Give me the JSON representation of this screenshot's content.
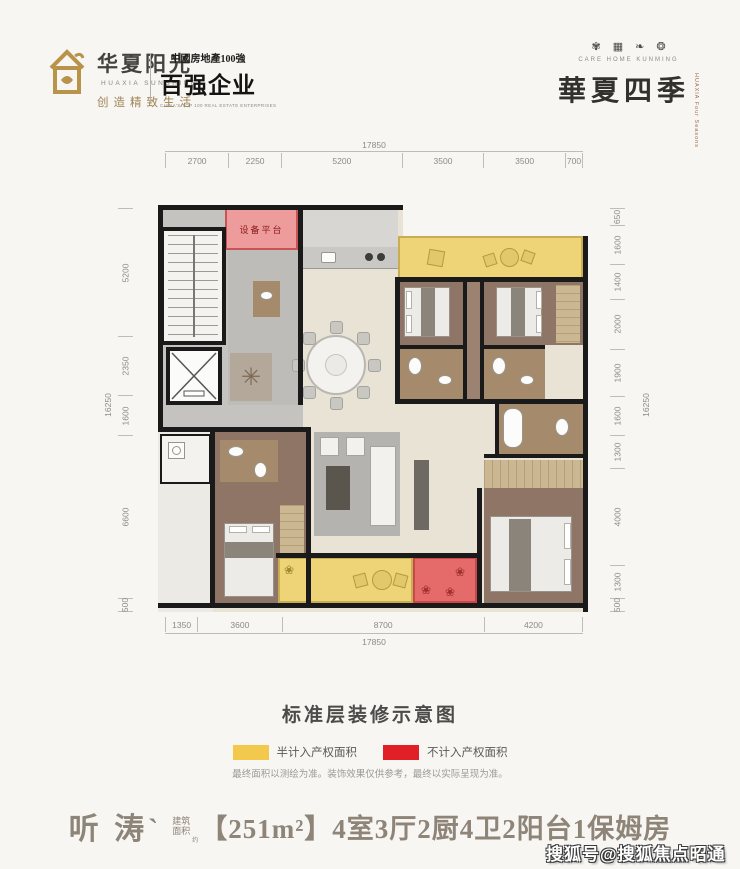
{
  "header": {
    "logo": {
      "brand_cn": "华夏阳光",
      "brand_en": "HUAXIA SUNSHINE",
      "tagline": "创造精致生活"
    },
    "badge": {
      "line1": "中國房地產100強",
      "line2": "百强企业",
      "caption": "CHINA'S TOP 100 REAL ESTATE ENTERPRISES"
    },
    "right": {
      "seals": [
        "✾",
        "▦",
        "❧",
        "❂"
      ],
      "caption": "CARE HOME KUNMING",
      "title": "華夏四季",
      "subtitle": "HUAXIA Four Seasons"
    }
  },
  "plan": {
    "equip_label": "设备平台",
    "dims": {
      "top": {
        "total": "17850",
        "segments": [
          2700,
          2250,
          5200,
          3500,
          3500,
          700
        ]
      },
      "bottom": {
        "total": "17850",
        "segments": [
          1350,
          3600,
          8700,
          4200
        ]
      },
      "left": {
        "total": "16250",
        "segments": [
          5200,
          2350,
          1600,
          6600,
          500
        ]
      },
      "right": {
        "total": "16250",
        "segments": [
          650,
          1600,
          1400,
          2000,
          1900,
          1600,
          1300,
          4000,
          1300,
          500
        ]
      }
    }
  },
  "caption": {
    "title": "标准层装修示意图",
    "legend": [
      {
        "color": "#f2c94c",
        "label": "半计入产权面积"
      },
      {
        "color": "#e01f26",
        "label": "不计入产权面积"
      }
    ],
    "note": "最终面积以测绘为准。装饰效果仅供参考，最终以实际呈现为准。"
  },
  "footer": {
    "name": "听 涛`",
    "area_word_top": "建筑",
    "area_word_bottom": "面积",
    "approx": "约",
    "spec": "【251m²】4室3厅2厨4卫2阳台1保姆房"
  },
  "watermark": "搜狐号@搜狐焦点昭通站"
}
